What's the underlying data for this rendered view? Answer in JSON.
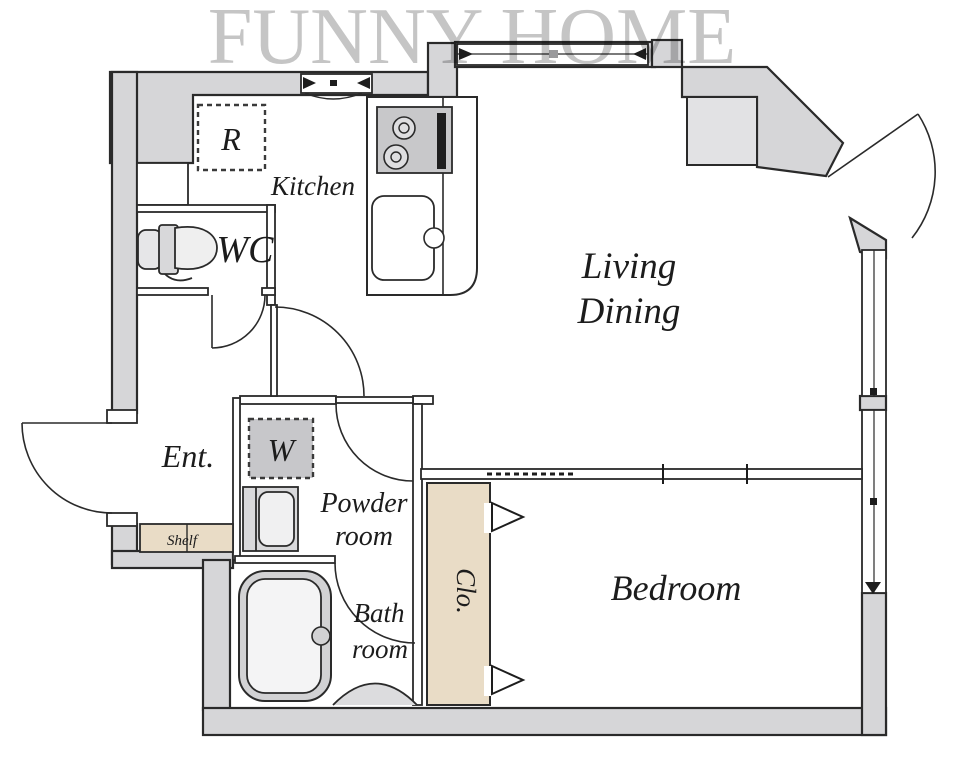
{
  "watermark": "FUNNY HOME",
  "rooms": {
    "kitchen": {
      "label": "Kitchen"
    },
    "wc": {
      "label": "WC"
    },
    "living_dining": {
      "line1": "Living",
      "line2": "Dining"
    },
    "entrance": {
      "label": "Ent."
    },
    "powder_room": {
      "line1": "Powder",
      "line2": "room"
    },
    "bath_room": {
      "line1": "Bath",
      "line2": "room"
    },
    "closet": {
      "label": "Clo."
    },
    "bedroom": {
      "label": "Bedroom"
    }
  },
  "fixtures": {
    "refrigerator": {
      "label": "R"
    },
    "washing_machine": {
      "label": "W"
    },
    "shelf": {
      "label": "Shelf"
    }
  },
  "colors": {
    "wall_fill": "#d6d6d8",
    "line": "#2a2a2a",
    "wood_fill": "#e9dcc6",
    "fixture_gray": "#c8c8ca",
    "watermark_gray": "#c5c5c5",
    "alcove_fill": "#e2e2e4"
  }
}
